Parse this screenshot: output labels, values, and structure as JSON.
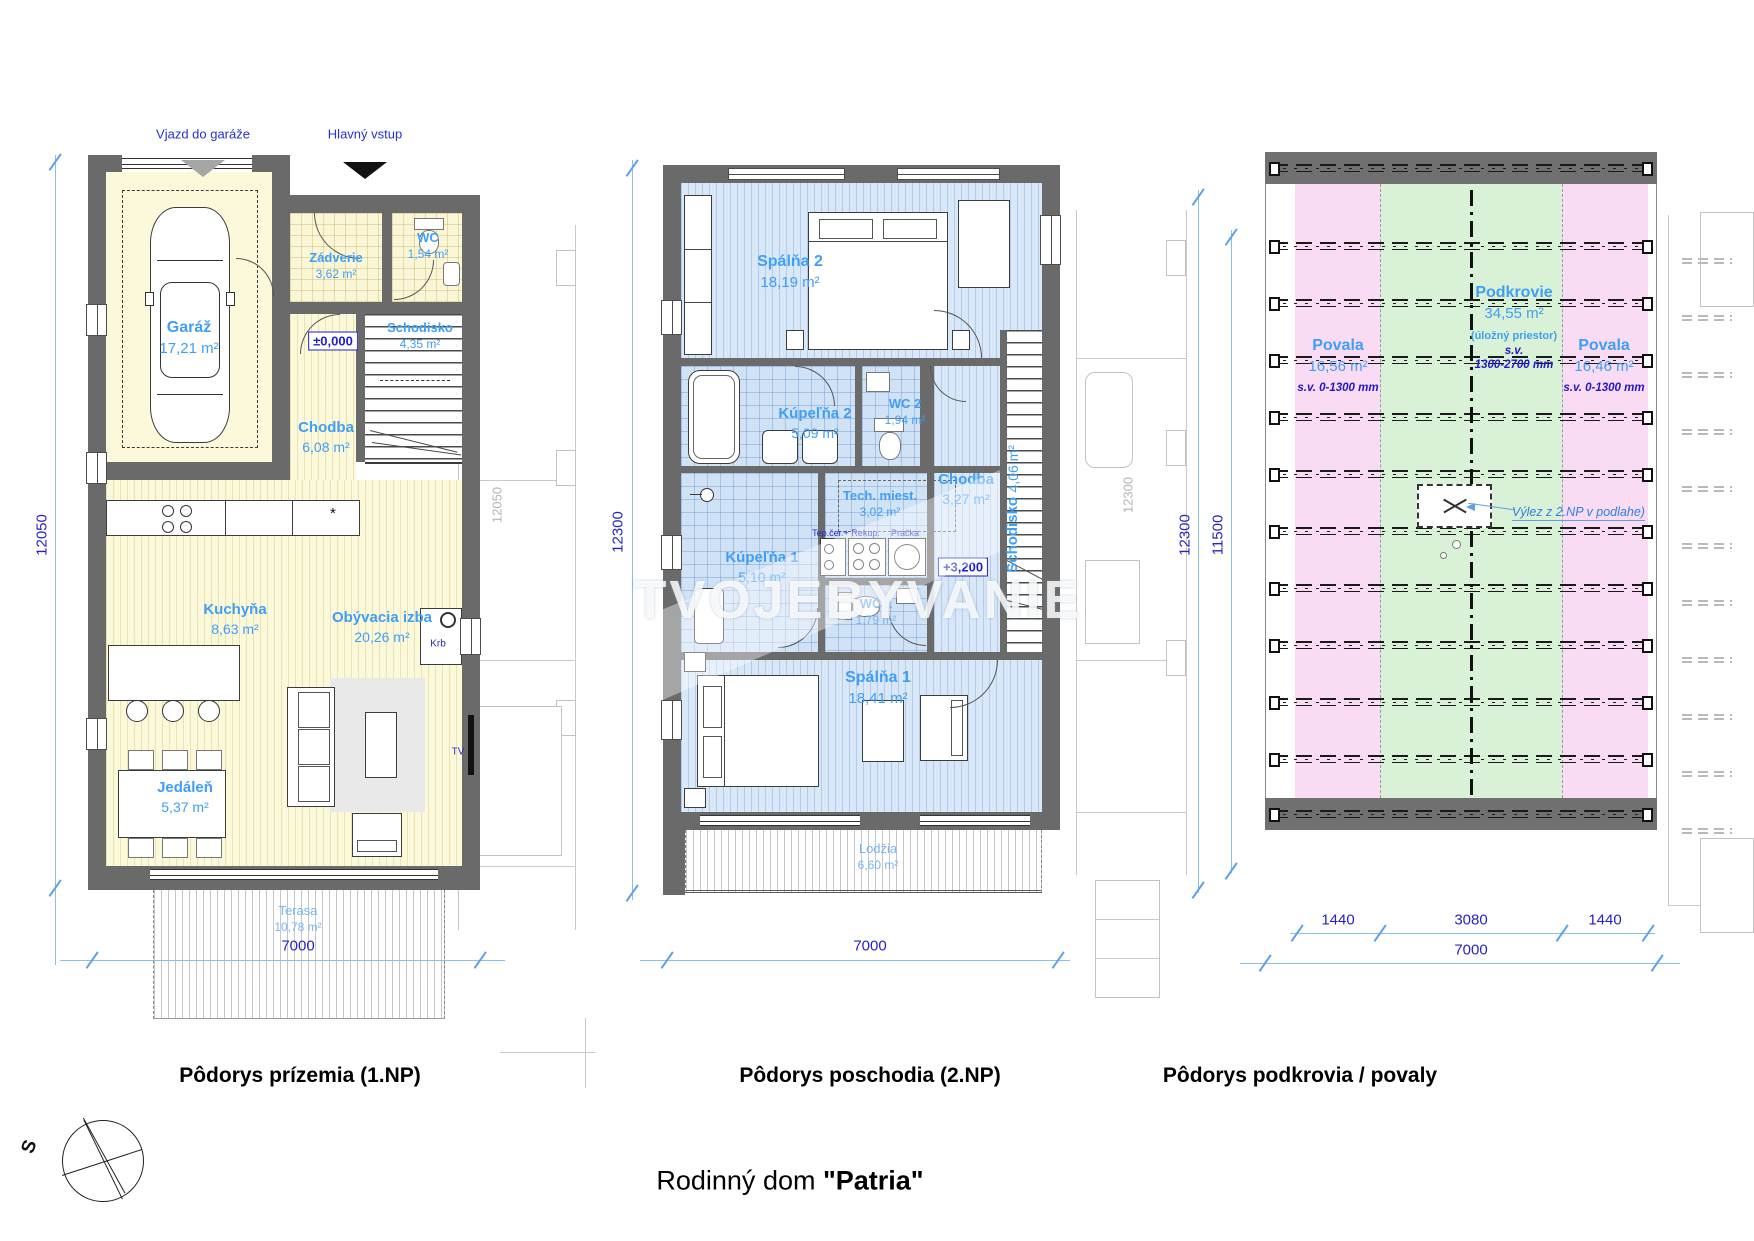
{
  "page": {
    "main_title_prefix": "Rodinný dom ",
    "main_title_name": "\"Patria\"",
    "compass_label": "S",
    "watermark": "TVOJEBYVANIE"
  },
  "ground": {
    "caption": "Pôdorys prízemia (1.NP)",
    "arrow_garage": "Vjazd do garáže",
    "arrow_main": "Hlavný vstup",
    "level": "±0,000",
    "star": "*",
    "krb": "Krb",
    "tv": "TV",
    "rooms": {
      "garaz": {
        "name": "Garáž",
        "area": "17,21 m²"
      },
      "zadverie": {
        "name": "Zádverie",
        "area": "3,62 m²"
      },
      "wc": {
        "name": "WC",
        "area": "1,54 m²"
      },
      "schodisko": {
        "name": "Schodisko",
        "area": "4,35 m²"
      },
      "chodba": {
        "name": "Chodba",
        "area": "6,08 m²"
      },
      "kuchyna": {
        "name": "Kuchyňa",
        "area": "8,63 m²"
      },
      "jedalen": {
        "name": "Jedáleň",
        "area": "5,37 m²"
      },
      "obyvacia": {
        "name": "Obývacia izba",
        "area": "20,26 m²"
      },
      "terasa": {
        "name": "Terasa",
        "area": "10,78 m²"
      }
    },
    "dim_w": "7000",
    "dim_h": "12050",
    "ghost_dim": "12050"
  },
  "upper": {
    "caption": "Pôdorys poschodia (2.NP)",
    "level": "+3,200",
    "tep": "Tep.čer.+ Rekup.",
    "pracka": "Práčka",
    "rooms": {
      "spalna2": {
        "name": "Spálňa 2",
        "area": "18,19 m²"
      },
      "kupelna2": {
        "name": "Kúpeľňa 2",
        "area": "5,09 m²"
      },
      "wc2": {
        "name": "WC 2",
        "area": "1,94 m²"
      },
      "chodba": {
        "name": "Chodba",
        "area": "3,27 m²"
      },
      "tech": {
        "name": "Tech. miest.",
        "area": "3,02 m²"
      },
      "kupelna1": {
        "name": "Kúpeľňa 1",
        "area": "5,10 m²"
      },
      "wc1": {
        "name": "WC 1",
        "area": "1,79 m²"
      },
      "schodisko": {
        "name": "Schodisko",
        "area": "4,06 m²"
      },
      "spalna1": {
        "name": "Spálňa 1",
        "area": "18,41 m²"
      },
      "lodzia": {
        "name": "Lodžia",
        "area": "6,60 m²"
      }
    },
    "dim_w": "7000",
    "dim_h": "12300",
    "ghost_dim": "12300"
  },
  "attic": {
    "caption": "Pôdorys podkrovia / povaly",
    "povala_l": {
      "name": "Povala",
      "area": "16,56 m²",
      "sv": "s.v. 0-1300 mm"
    },
    "podkrovie": {
      "name": "Podkrovie",
      "area": "34,55 m²",
      "note": "(úložný priestor)",
      "sv1": "s.v.",
      "sv2": "1300-2700 mm"
    },
    "povala_r": {
      "name": "Povala",
      "area": "16,46 m²",
      "sv": "s.v. 0-1300 mm"
    },
    "hatch_label": "Výlez z 2.NP v podlahe)",
    "dim_a": "1440",
    "dim_b": "3080",
    "dim_c": "1440",
    "dim_w": "7000",
    "dim_h1": "12300",
    "dim_h2": "11500"
  }
}
